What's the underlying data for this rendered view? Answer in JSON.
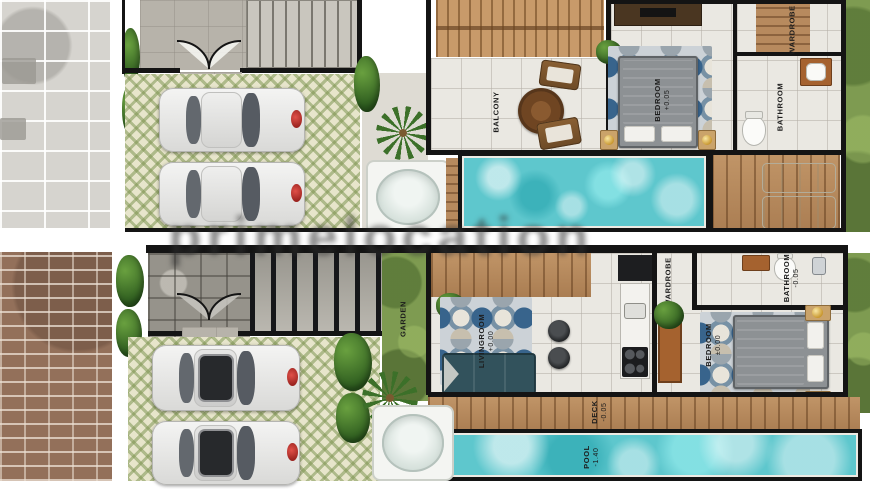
{
  "watermark": {
    "text": "primelocation"
  },
  "palette": {
    "pool_water": "#5ec7cd",
    "wall": "#141414",
    "wood": "#b78a5e",
    "grass": "#7e9b51",
    "label_ink": "#1c1c1c"
  },
  "plans": {
    "upper": {
      "name": "upper-villa-plan",
      "rooms": {
        "balcony": {
          "label": "BALCONY"
        },
        "bedroom": {
          "label": "BEDROOM",
          "level": "+0.05"
        },
        "wardrobe": {
          "label": "WARDROBE"
        },
        "bathroom": {
          "label": "BATHROOM"
        }
      }
    },
    "ground": {
      "name": "ground-villa-plan",
      "rooms": {
        "garden": {
          "label": "GARDEN"
        },
        "livingroom": {
          "label": "LIVINGROOM",
          "level": "+0.00"
        },
        "wardrobe": {
          "label": "WARDROBE"
        },
        "bathroom": {
          "label": "BATHROOM",
          "level": "-0.05"
        },
        "bedroom": {
          "label": "BEDROOM",
          "level": "±0.00"
        },
        "deck": {
          "label": "DECK",
          "level": "-0.05"
        },
        "pool": {
          "label": "POOL",
          "level": "-1.40"
        }
      }
    }
  }
}
